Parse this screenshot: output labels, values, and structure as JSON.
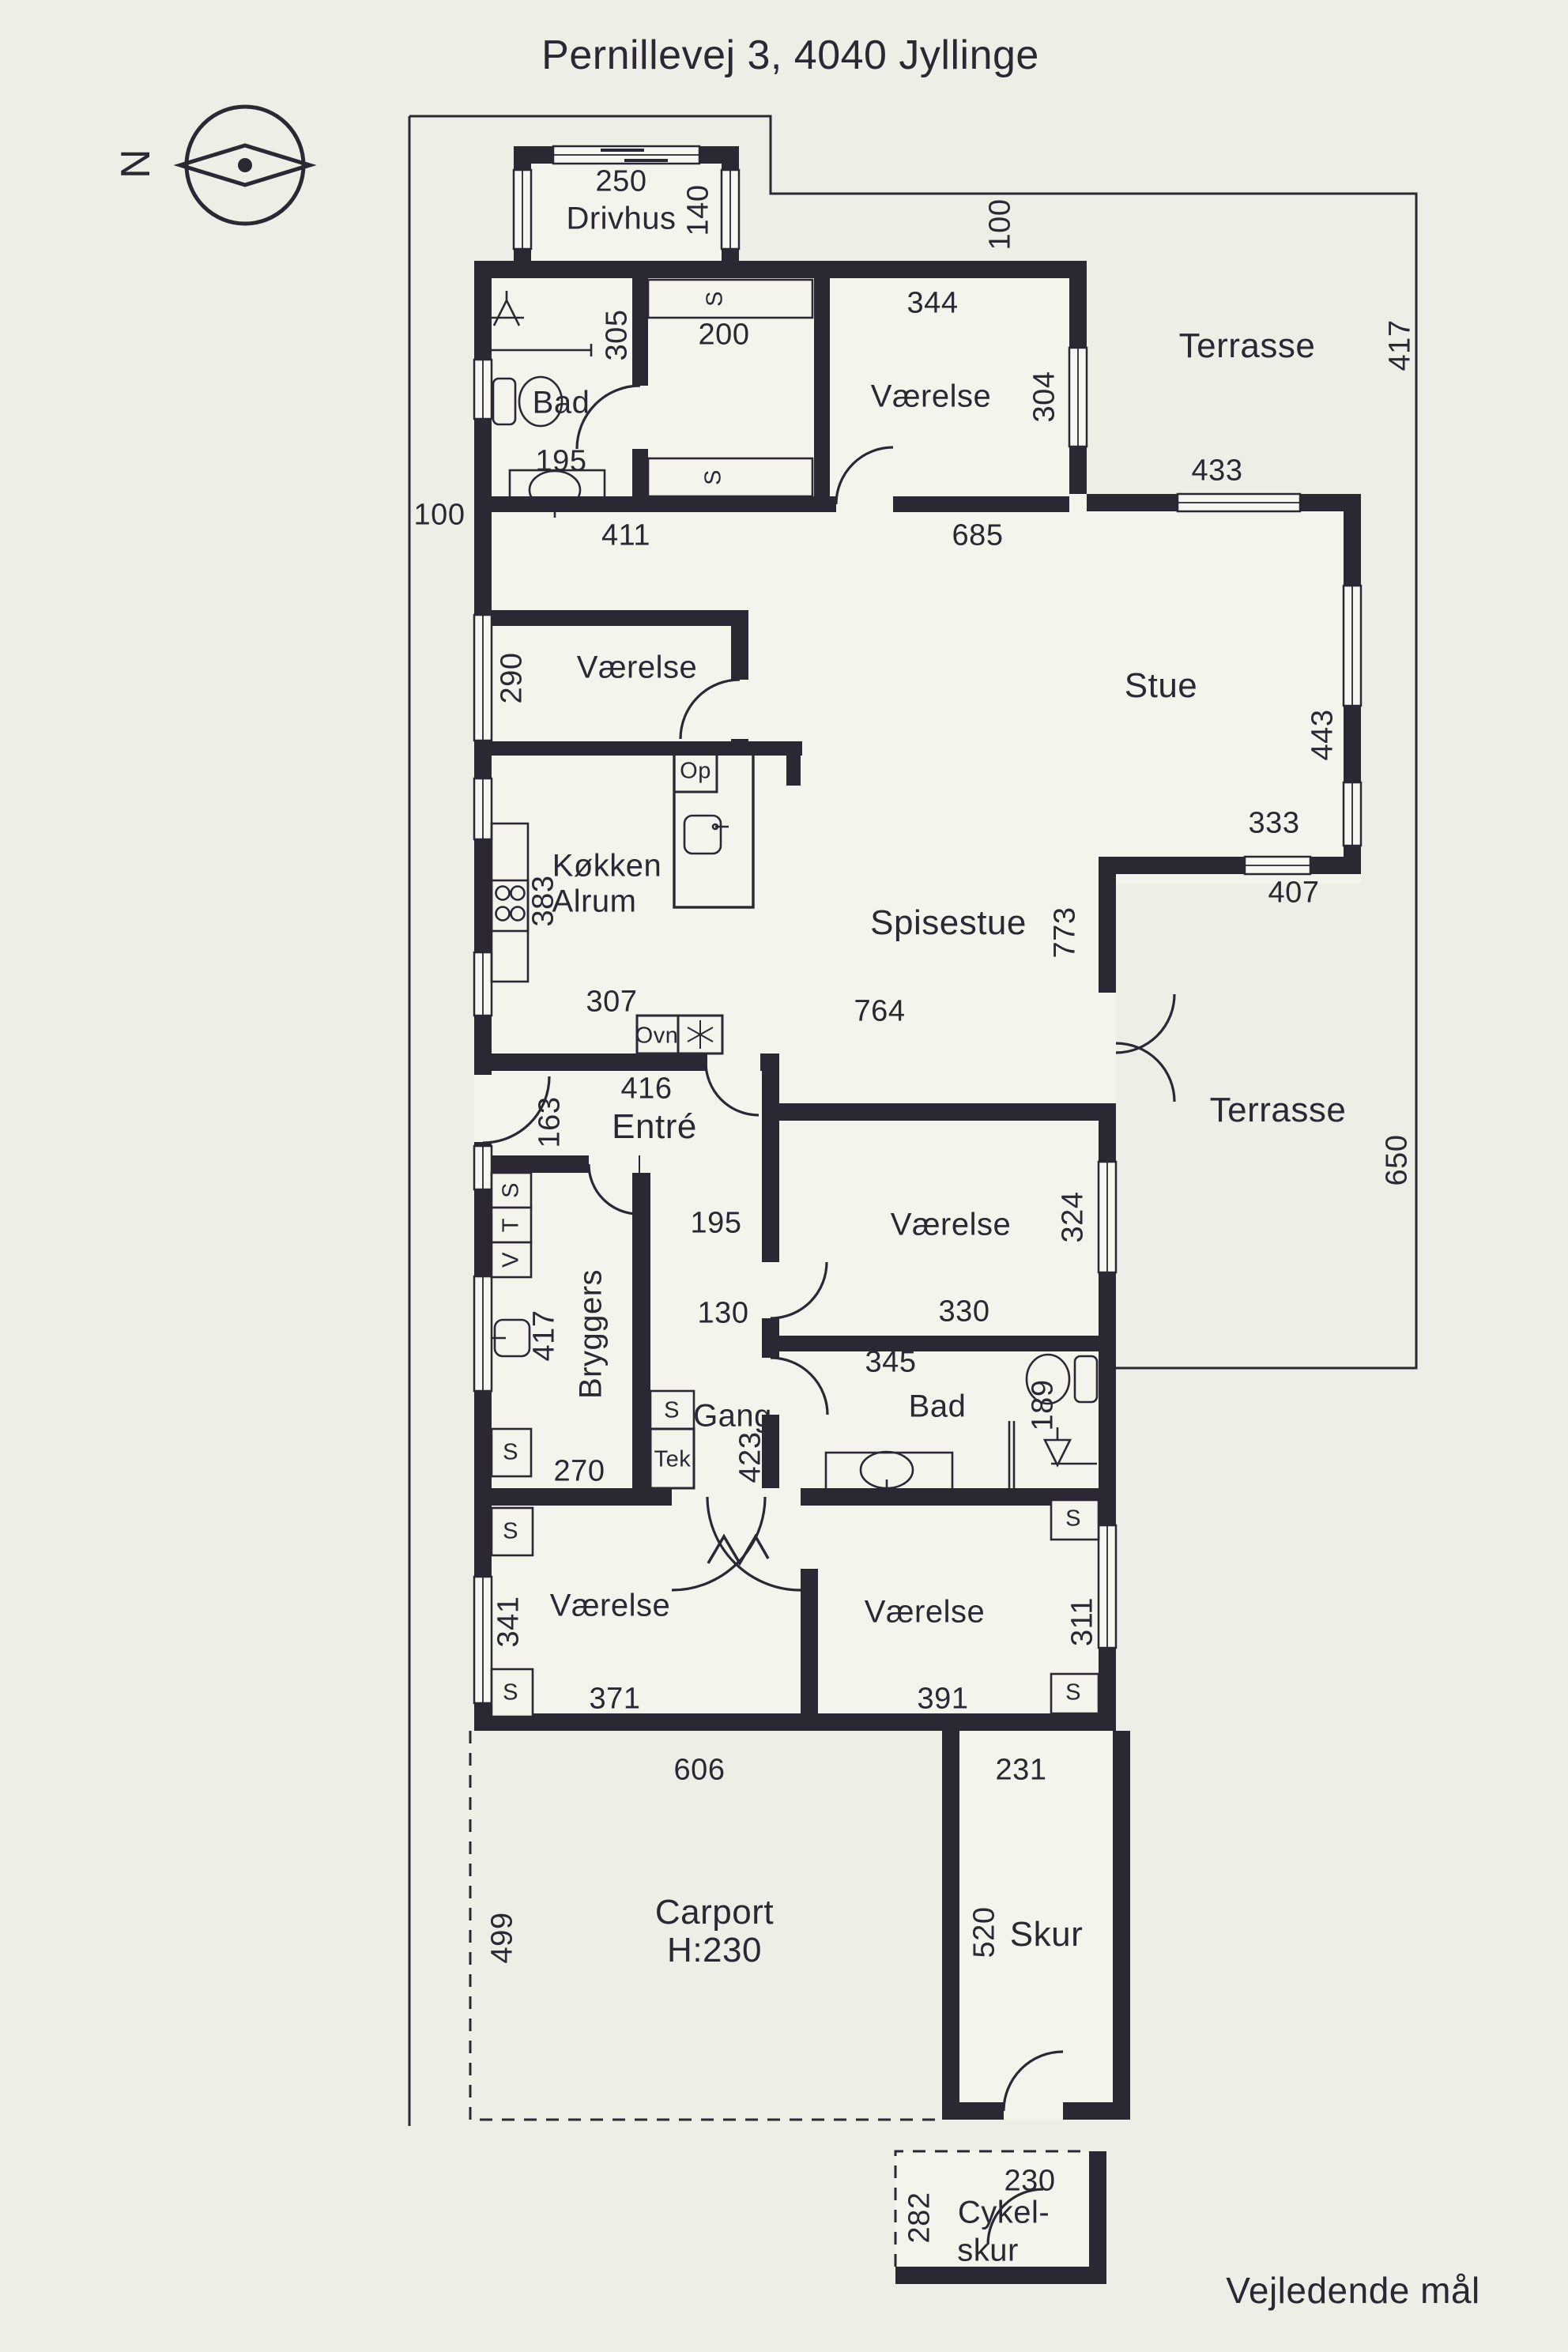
{
  "header": {
    "title": "Pernillevej 3, 4040 Jyllinge"
  },
  "footer": {
    "note": "Vejledende mål"
  },
  "compass": {
    "north": "N"
  },
  "colors": {
    "background": "#eeede6",
    "floor": "#f4f3ec",
    "wall": "#2b2733",
    "window": "#f7f6f1"
  },
  "drivhus": {
    "name": "Drivhus",
    "width": "250",
    "depth": "140"
  },
  "site": {
    "dist_top": "100",
    "dist_left": "100",
    "boundary_e_top": "417",
    "boundary_e_mid": "650"
  },
  "top_rooms": {
    "bad": {
      "name": "Bad",
      "width": "195",
      "depth": "305"
    },
    "dressing": {
      "closet_n": "S",
      "closet_s": "S",
      "width": "200"
    },
    "vaerelse": {
      "name": "Værelse",
      "width": "344",
      "depth": "304"
    },
    "terrasse": {
      "name": "Terrasse",
      "window": "433"
    }
  },
  "hall": {
    "width": "411",
    "stue_width": "685"
  },
  "vaerelse_w": {
    "name": "Værelse",
    "depth": "290"
  },
  "stue": {
    "name": "Stue",
    "depth": "443"
  },
  "koekken": {
    "line1": "Køkken",
    "line2": "Alrum",
    "depth": "383",
    "width": "307",
    "op": "Op",
    "ovn": "Ovn"
  },
  "spisestue": {
    "name": "Spisestue",
    "depth": "773",
    "width": "764",
    "win_top": "333",
    "win_bottom": "407"
  },
  "entre": {
    "name": "Entré",
    "width": "416",
    "depth": "163",
    "closets": [
      "S",
      "T",
      "V"
    ]
  },
  "terrasse_e": {
    "name": "Terrasse"
  },
  "gang": {
    "name": "Gang",
    "length": "423",
    "w1": "195",
    "w2": "130",
    "closet": "S",
    "tek": "Tek"
  },
  "vaerelse_m": {
    "name": "Værelse",
    "width": "330",
    "window": "324"
  },
  "bad_s": {
    "name": "Bad",
    "width": "345",
    "depth": "189",
    "closet": "S"
  },
  "bryggers": {
    "name": "Bryggers",
    "depth": "417",
    "width": "270",
    "closet": "S"
  },
  "vaerelse_bl": {
    "name": "Værelse",
    "width": "371",
    "window": "341",
    "closet_n": "S",
    "closet_s": "S"
  },
  "vaerelse_br": {
    "name": "Værelse",
    "width": "391",
    "window": "311",
    "closet_n": "S",
    "closet_s": "S"
  },
  "south_dims": {
    "w1": "606",
    "w2": "231"
  },
  "carport": {
    "name": "Carport",
    "height": "H:230",
    "depth": "499"
  },
  "skur": {
    "name": "Skur",
    "length": "520"
  },
  "cykelskur": {
    "line1": "Cykel-",
    "line2": "skur",
    "width": "230",
    "depth": "282"
  }
}
